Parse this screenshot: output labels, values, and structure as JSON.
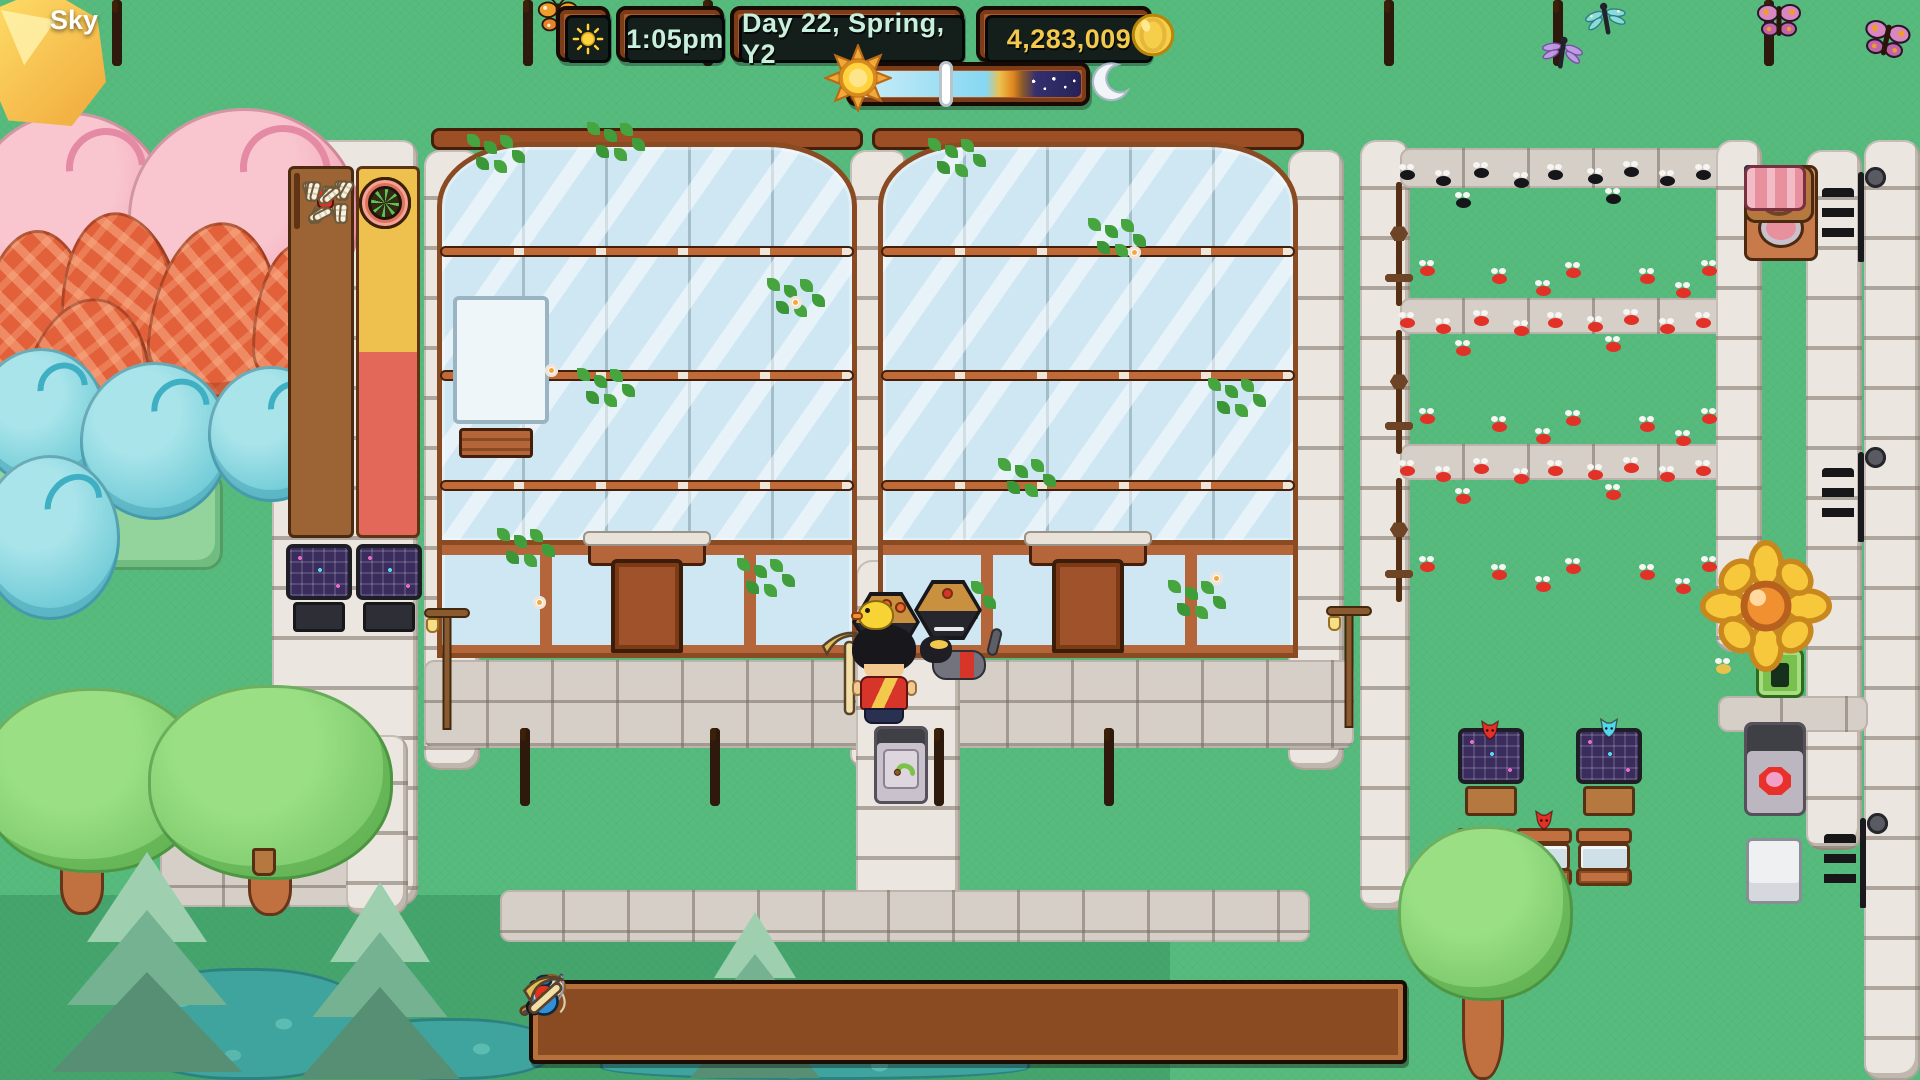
{
  "player": {
    "name_label": "Sky",
    "held_item": "pickaxe",
    "companions": [
      "duck",
      "cat"
    ]
  },
  "hud": {
    "weather_icon": "sun",
    "time": "1:05pm",
    "date": "Day 22, Spring, Y2",
    "money": "4,283,009",
    "coin_icon": "coin",
    "day_progress": {
      "marker_pct": 37
    }
  },
  "hotbar": {
    "selected_index": 1,
    "slots": [
      "axe",
      "pickaxe",
      "net",
      "fishing-rod",
      "",
      "",
      "",
      "",
      "",
      "potion"
    ]
  },
  "world": {
    "beehives": {
      "cols": 5,
      "rows": [
        {
          "top_bees": "black",
          "bottom_bees": "red"
        },
        {
          "top_bees": "red",
          "bottom_bees": "red"
        },
        {
          "top_bees": "red",
          "bottom_bees": "red"
        }
      ]
    },
    "worm_boxes": {
      "count": 6,
      "red_bug_box_index": 3
    },
    "extractor_cells": [
      "gold",
      "gold",
      "gold",
      "red",
      "red",
      "red"
    ],
    "press_chain_segments": 3,
    "aquariums": 4,
    "greenhouses": 2,
    "critters": [
      "butterfly",
      "dragonfly",
      "caterpillar",
      "fish",
      "snail",
      "shell",
      "white-bug"
    ]
  },
  "palette": {
    "grass": "#58bb7e",
    "grass-dark": "#45a56d",
    "hud-text": "#c9f0dc",
    "money-text": "#f2c94c",
    "selection-red": "#e8311c",
    "bee-red": "#e23127"
  }
}
